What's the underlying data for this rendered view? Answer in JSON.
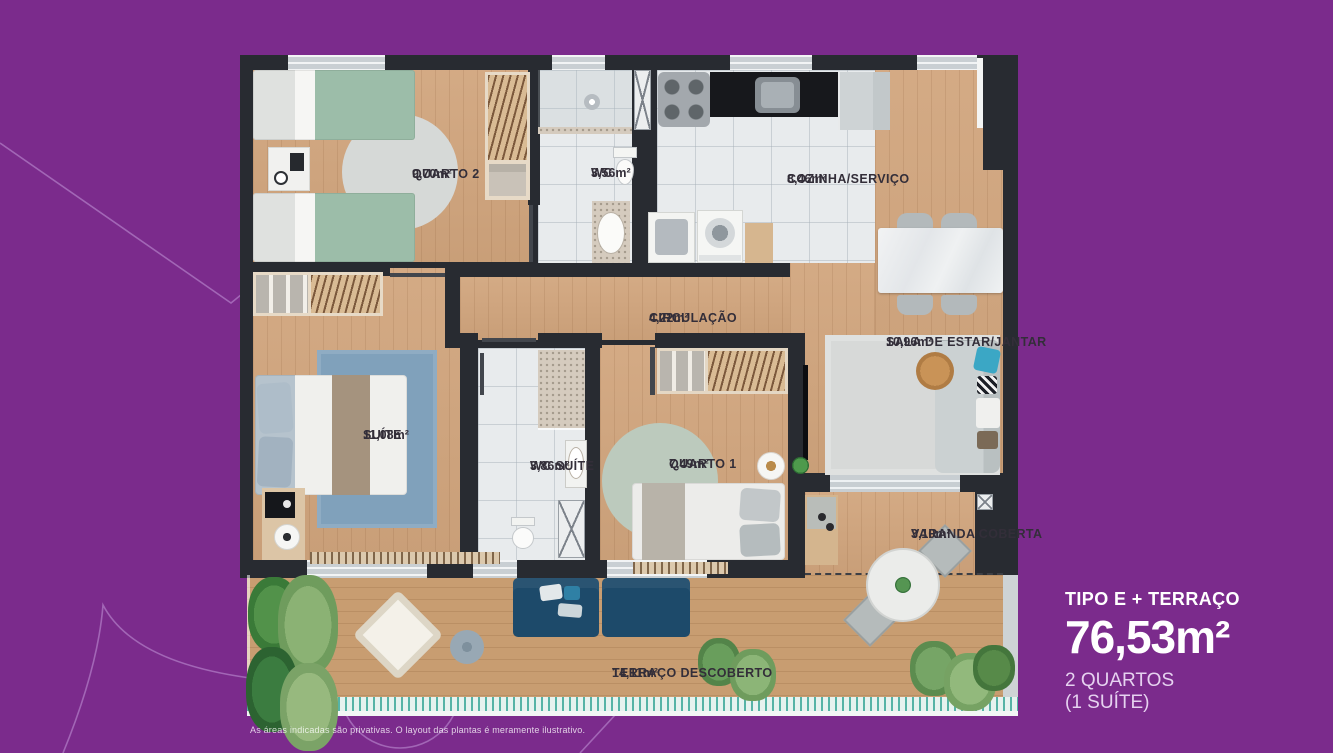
{
  "palette": {
    "background": "#7b2b8c",
    "wall": "#282b31",
    "wood_floor": "#d1a57d",
    "terrace_floor": "#c89d71",
    "tile_floor": "#e8ebed",
    "label_text": "#332e39",
    "summary_text": "#ffffff",
    "summary_subtext": "#e6d2f0",
    "deco_line": "#bd8ed2",
    "navy_sofa": "#1d4a6a",
    "rail_teal": "#56b3a6"
  },
  "plan": {
    "rooms": [
      {
        "name": "QUARTO 2",
        "area": "9,70m²"
      },
      {
        "name": "WC",
        "area": "3,56m²"
      },
      {
        "name": "COZINHA/SERVIÇO",
        "area": "8,46m²"
      },
      {
        "name": "CIRCULAÇÃO",
        "area": "4,22m²"
      },
      {
        "name": "SALA DE ESTAR/JANTAR",
        "area": "10,96m²"
      },
      {
        "name": "SUÍTE",
        "area": "11,08m²"
      },
      {
        "name": "WC SUÍTE",
        "area": "3,86m²"
      },
      {
        "name": "QUARTO 1",
        "area": "7,49m²"
      },
      {
        "name": "VARANDA COBERTA",
        "area": "3,10m²"
      },
      {
        "name": "TERRAÇO DESCOBERTO",
        "area": "14,11m²"
      }
    ]
  },
  "summary": {
    "type_label": "TIPO E + TERRAÇO",
    "total_area": "76,53m²",
    "bedrooms": "2 QUARTOS",
    "suite_note": "(1 SUÍTE)"
  },
  "disclaimer": "As áreas indicadas são privativas. O layout das plantas é meramente ilustrativo."
}
